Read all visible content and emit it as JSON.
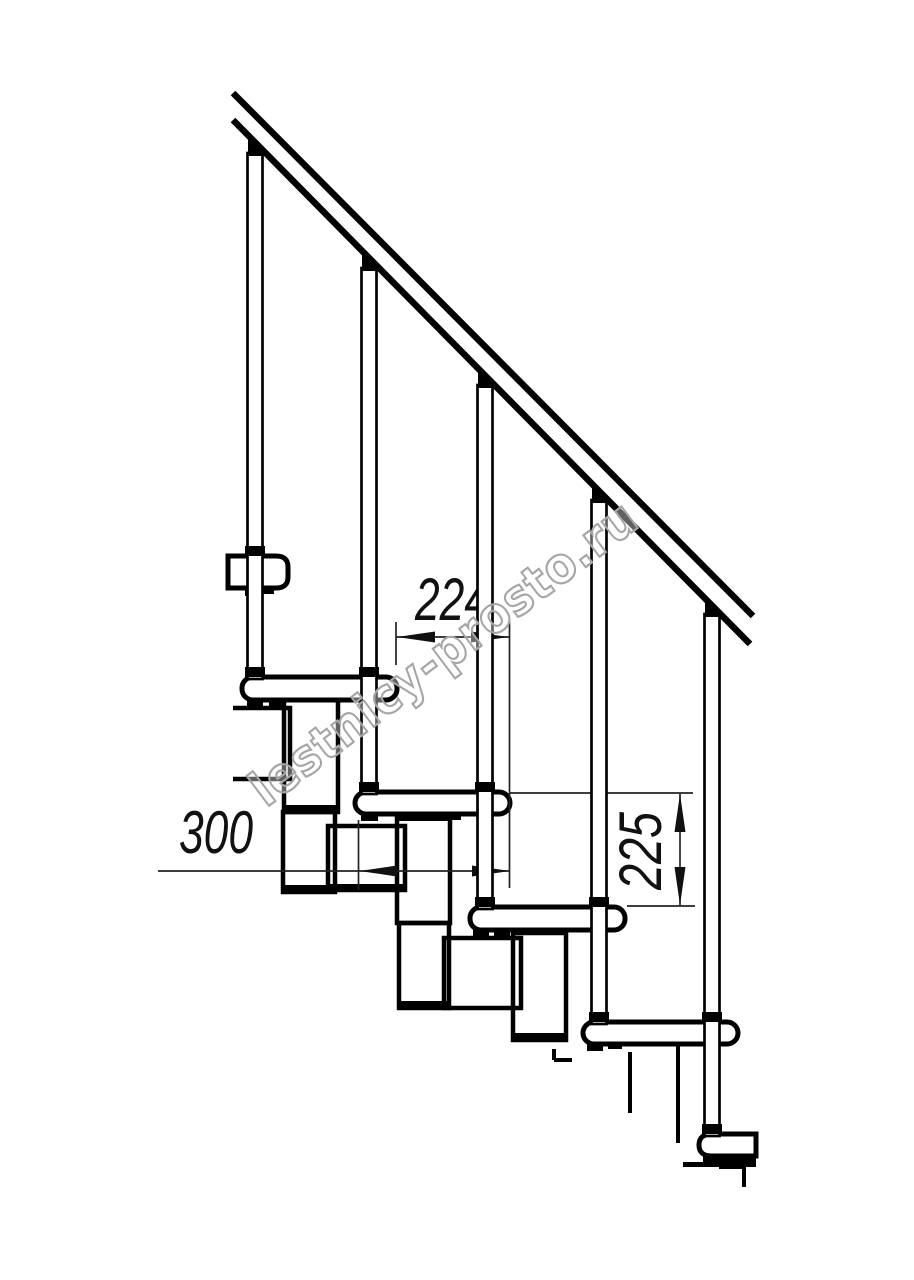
{
  "figure": {
    "type": "technical-drawing",
    "subject": "modular staircase side view with handrail",
    "treads_visible": 6,
    "balusters_visible": 5
  },
  "dimensions": {
    "run": {
      "label": "224"
    },
    "module_depth": {
      "label": "300"
    },
    "rise": {
      "label": "225"
    }
  },
  "watermark": {
    "text": "lestnicy-prosto.ru"
  },
  "colors": {
    "background": "#ffffff",
    "line": "#000000",
    "dimension_line": "#222222",
    "watermark_stroke": "#a6a6a6"
  }
}
